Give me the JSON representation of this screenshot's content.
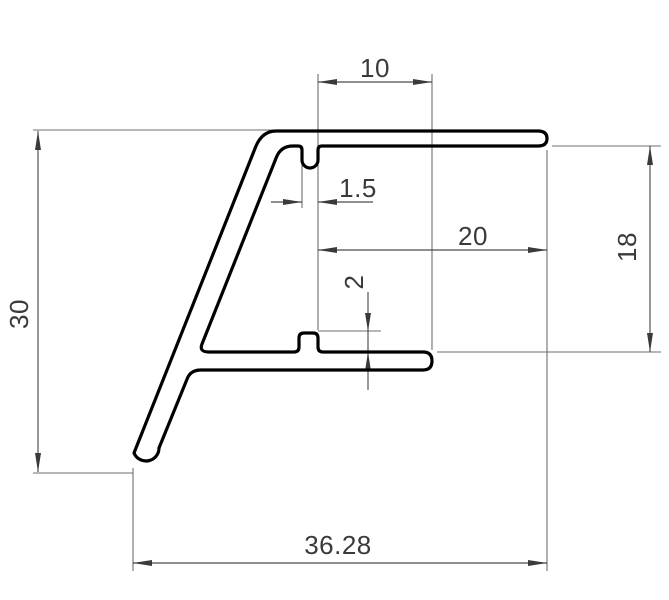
{
  "drawing": {
    "kind": "technical-cross-section",
    "background": "#ffffff",
    "outline_color": "#000000",
    "dimension_color": "#4c4c4c",
    "dimensions": {
      "overall_height": "30",
      "overall_width": "36.28",
      "top_offset": "10",
      "notch_width": "1.5",
      "flange_length": "20",
      "right_height": "18",
      "rib_height": "2"
    }
  }
}
